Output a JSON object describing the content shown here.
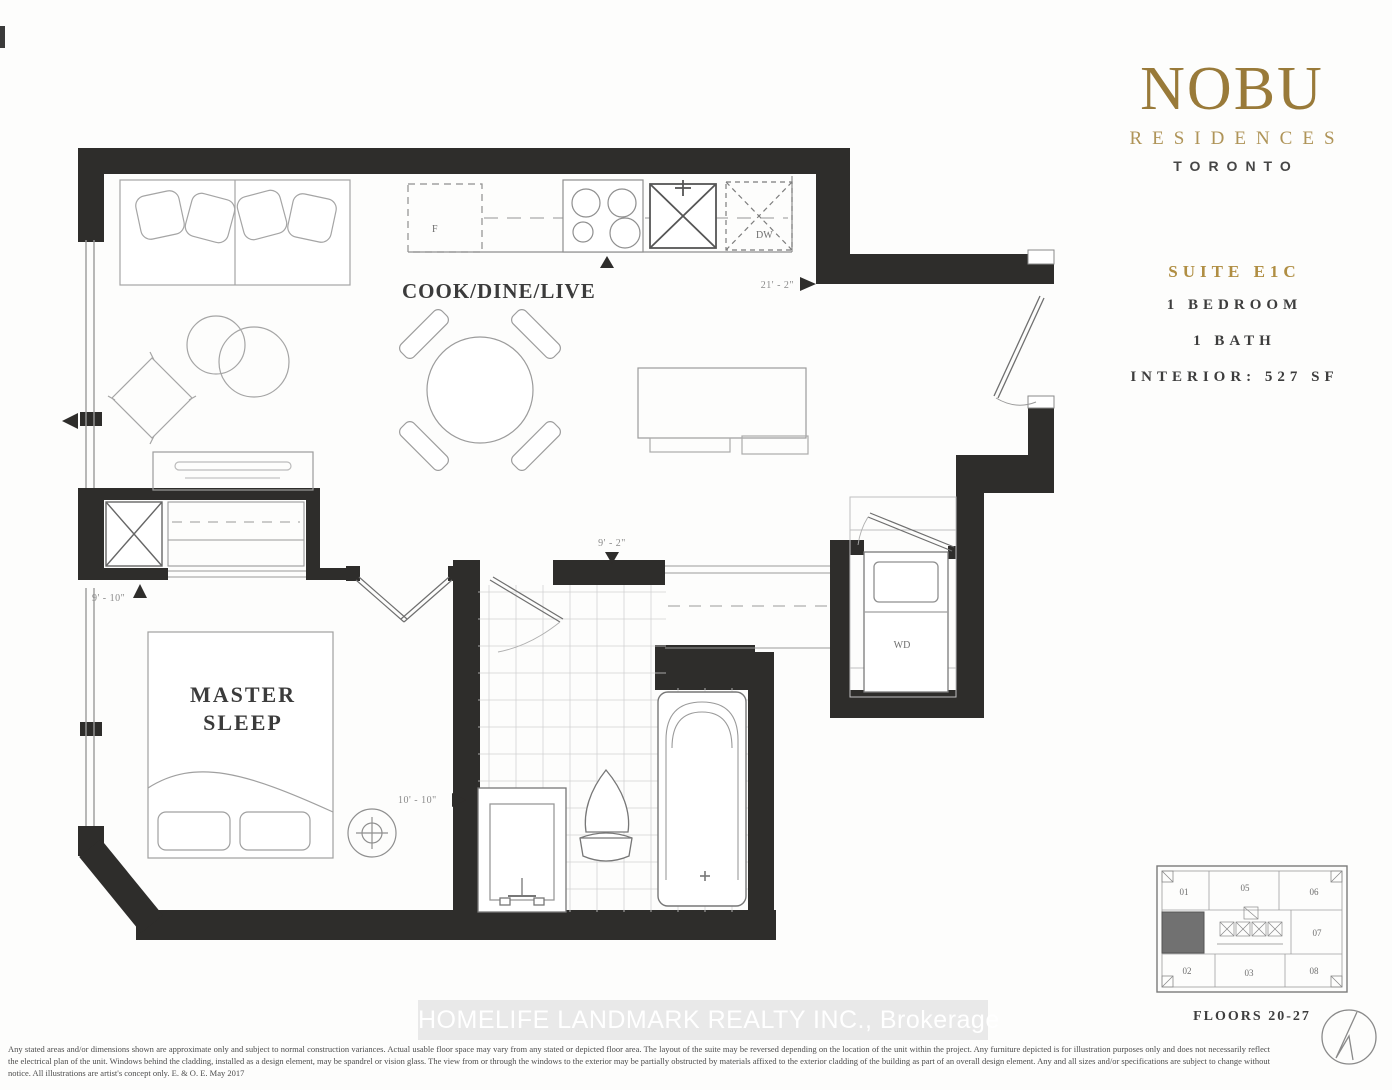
{
  "branding": {
    "logo": "NOBU",
    "residences": "RESIDENCES",
    "city": "TORONTO"
  },
  "suite": {
    "title": "SUITE E1C",
    "bedroom": "1 BEDROOM",
    "bath": "1 BATH",
    "interior": "INTERIOR: 527 SF"
  },
  "plan": {
    "labels": {
      "cook_dine_live": "COOK/DINE/LIVE",
      "master": "MASTER",
      "sleep": "SLEEP",
      "washer_dryer": "WD",
      "fridge": "F",
      "dishwasher": "DW"
    },
    "dims": {
      "living_length": "21' - 2\"",
      "hall_width": "9' - 2\"",
      "bedroom_width": "10' - 10\"",
      "bedroom_depth": "9' - 10\""
    }
  },
  "keyplan": {
    "floors_label": "FLOORS 20-27",
    "units": [
      "01",
      "05",
      "06",
      "07",
      "02",
      "03",
      "08"
    ]
  },
  "watermark": {
    "text": "HOMELIFE LANDMARK REALTY INC., Brokerage"
  },
  "disclaimer": {
    "text": "Any stated areas and/or dimensions shown are approximate only and subject to normal construction variances. Actual usable floor space may vary from any stated or depicted floor area. The layout of the suite may be reversed depending on the location of the unit within the project. Any furniture depicted is for illustration purposes only and does not necessarily reflect the electrical plan of the unit. Windows behind the cladding, installed as a design element, may be spandrel or vision glass. The view from or through the windows to the exterior may be partially obstructed by materials affixed to the exterior cladding of the building as part of an overall design element. Any and all sizes and/or specifications are subject to change without notice. All illustrations are artist's concept only. E. & O. E. May 2017"
  },
  "colors": {
    "wall": "#2e2d2b",
    "brand_gold": "#997a39",
    "brand_gold_light": "#af9458",
    "keyplan_highlight": "#717171"
  }
}
